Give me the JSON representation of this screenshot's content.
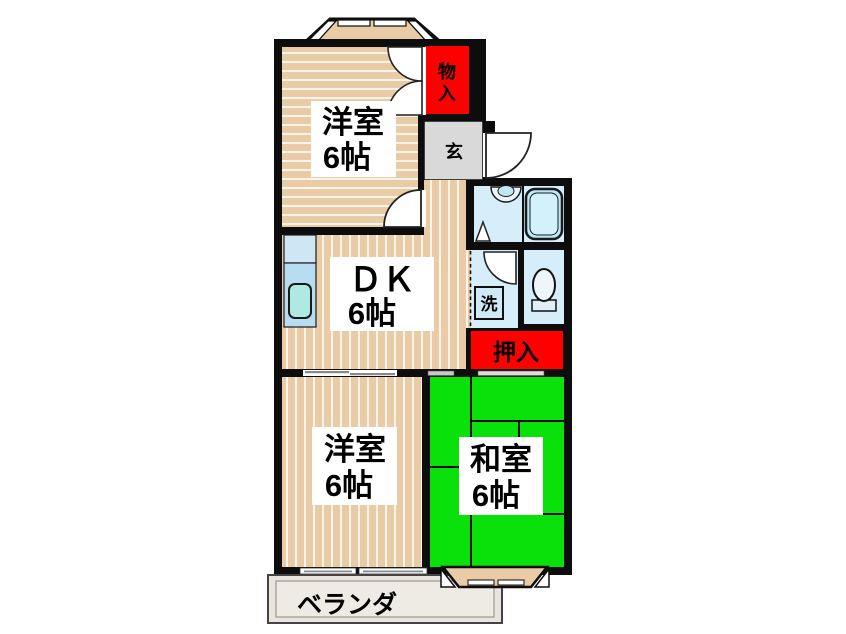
{
  "plan": {
    "rooms": {
      "western_top": {
        "name": "洋室",
        "size": "6帖"
      },
      "dk": {
        "name": "ＤＫ",
        "size": "6帖"
      },
      "western_bottom": {
        "name": "洋室",
        "size": "6帖"
      },
      "japanese": {
        "name": "和室",
        "size": "6帖"
      }
    },
    "labels": {
      "storage_top_char1": "物",
      "storage_top_char2": "入",
      "entrance": "玄",
      "closet": "押入",
      "laundry": "洗",
      "veranda": "ベランダ"
    },
    "colors": {
      "tatami_green": "#0ae00a",
      "closet_red": "#fe0000",
      "wood_tan": "#e9cba6",
      "entrance_gray": "#d9d9d9",
      "bath_blue": "#d6eef9",
      "wall": "#0d0d0d"
    }
  }
}
